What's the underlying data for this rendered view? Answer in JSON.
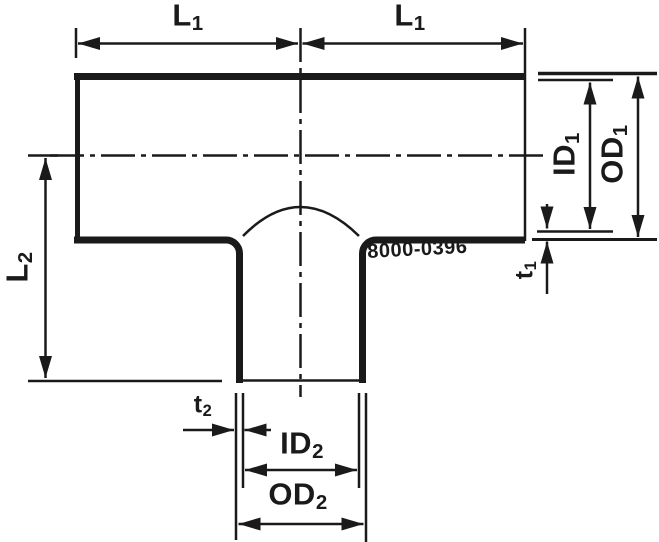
{
  "drawing": {
    "part_number": "8000-0396",
    "line_color": "#1a1a1a",
    "background_color": "#ffffff",
    "labels": {
      "l1_left": {
        "base": "L",
        "sub": "1"
      },
      "l1_right": {
        "base": "L",
        "sub": "1"
      },
      "id1": {
        "base": "ID",
        "sub": "1"
      },
      "od1": {
        "base": "OD",
        "sub": "1"
      },
      "t1": {
        "base": "t",
        "sub": "1"
      },
      "l2": {
        "base": "L",
        "sub": "2"
      },
      "t2": {
        "base": "t",
        "sub": "2"
      },
      "id2": {
        "base": "ID",
        "sub": "2"
      },
      "od2": {
        "base": "OD",
        "sub": "2"
      }
    }
  }
}
